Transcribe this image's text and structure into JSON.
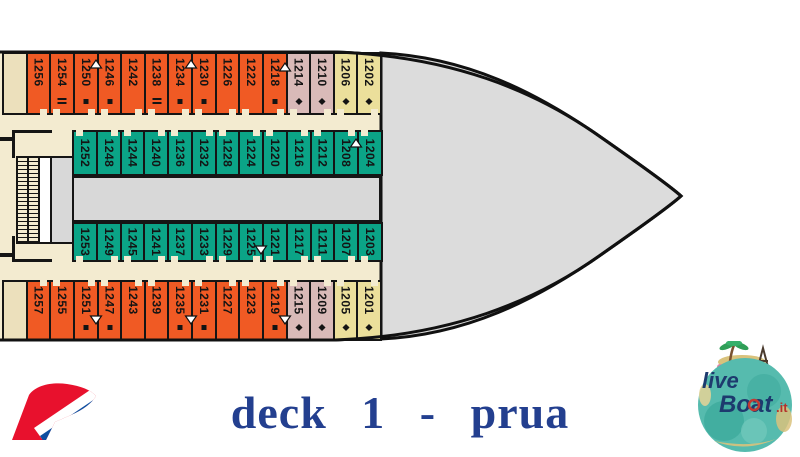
{
  "footer": {
    "title": "deck 1 - prua"
  },
  "logos": {
    "carnival": "carnival-funnel-logo",
    "liveboat": {
      "live": "live",
      "boat": "Boat",
      "it": ".it"
    }
  },
  "colors": {
    "cabin_orange": "#f05a24",
    "cabin_teal": "#0ba487",
    "cabin_pink": "#d9bab8",
    "cabin_yellow": "#ebdf9b",
    "corridor_cream": "#f3ebd0",
    "hull_gray": "#dcdcdc",
    "title_blue": "#233f8f"
  },
  "deck": {
    "rows": [
      {
        "name": "cabins-top-outer",
        "y": 52,
        "h": 63,
        "x0": 2,
        "x1": 380,
        "door": "bottom",
        "center": false,
        "cabins": [
          {
            "n": "",
            "t": "empty"
          },
          {
            "n": "1256",
            "t": "orange"
          },
          {
            "n": "1254",
            "t": "orange",
            "sym": "dblbar"
          },
          {
            "n": "1250",
            "t": "orange",
            "sym": "square"
          },
          {
            "n": "1246",
            "t": "orange",
            "sym": "square"
          },
          {
            "n": "1242",
            "t": "orange"
          },
          {
            "n": "1238",
            "t": "orange",
            "sym": "dblbar"
          },
          {
            "n": "1234",
            "t": "orange",
            "sym": "square"
          },
          {
            "n": "1230",
            "t": "orange",
            "sym": "square"
          },
          {
            "n": "1226",
            "t": "orange"
          },
          {
            "n": "1222",
            "t": "orange"
          },
          {
            "n": "1218",
            "t": "orange",
            "sym": "square"
          },
          {
            "n": "1214",
            "t": "pink",
            "sym": "diamond"
          },
          {
            "n": "1210",
            "t": "pink",
            "sym": "diamond"
          },
          {
            "n": "1206",
            "t": "beige",
            "sym": "diamond"
          },
          {
            "n": "1202",
            "t": "beige",
            "sym": "diamond"
          }
        ]
      },
      {
        "name": "cabins-top-inner",
        "y": 130,
        "h": 46,
        "x0": 72,
        "x1": 381,
        "door": "top",
        "center": true,
        "cabins": [
          {
            "n": "1252",
            "t": "teal"
          },
          {
            "n": "1248",
            "t": "teal"
          },
          {
            "n": "1244",
            "t": "teal"
          },
          {
            "n": "1240",
            "t": "teal"
          },
          {
            "n": "1236",
            "t": "teal"
          },
          {
            "n": "1232",
            "t": "teal"
          },
          {
            "n": "1228",
            "t": "teal"
          },
          {
            "n": "1224",
            "t": "teal"
          },
          {
            "n": "1220",
            "t": "teal"
          },
          {
            "n": "1216",
            "t": "teal"
          },
          {
            "n": "1212",
            "t": "teal"
          },
          {
            "n": "1208",
            "t": "teal"
          },
          {
            "n": "1204",
            "t": "teal"
          }
        ]
      },
      {
        "name": "cabins-bottom-inner",
        "y": 222,
        "h": 40,
        "x0": 72,
        "x1": 381,
        "door": "bottom",
        "center": true,
        "cabins": [
          {
            "n": "1253",
            "t": "teal"
          },
          {
            "n": "1249",
            "t": "teal"
          },
          {
            "n": "1245",
            "t": "teal"
          },
          {
            "n": "1241",
            "t": "teal"
          },
          {
            "n": "1237",
            "t": "teal"
          },
          {
            "n": "1233",
            "t": "teal"
          },
          {
            "n": "1229",
            "t": "teal"
          },
          {
            "n": "1225",
            "t": "teal"
          },
          {
            "n": "1221",
            "t": "teal"
          },
          {
            "n": "1217",
            "t": "teal"
          },
          {
            "n": "1211",
            "t": "teal"
          },
          {
            "n": "1207",
            "t": "teal"
          },
          {
            "n": "1203",
            "t": "teal"
          }
        ]
      },
      {
        "name": "cabins-bottom-outer",
        "y": 280,
        "h": 61,
        "x0": 2,
        "x1": 380,
        "door": "top",
        "center": false,
        "cabins": [
          {
            "n": "",
            "t": "empty"
          },
          {
            "n": "1257",
            "t": "orange"
          },
          {
            "n": "1255",
            "t": "orange"
          },
          {
            "n": "1251",
            "t": "orange",
            "sym": "square"
          },
          {
            "n": "1247",
            "t": "orange",
            "sym": "square"
          },
          {
            "n": "1243",
            "t": "orange"
          },
          {
            "n": "1239",
            "t": "orange"
          },
          {
            "n": "1235",
            "t": "orange",
            "sym": "square"
          },
          {
            "n": "1231",
            "t": "orange",
            "sym": "square"
          },
          {
            "n": "1227",
            "t": "orange"
          },
          {
            "n": "1223",
            "t": "orange"
          },
          {
            "n": "1219",
            "t": "orange",
            "sym": "square"
          },
          {
            "n": "1215",
            "t": "pink",
            "sym": "diamond"
          },
          {
            "n": "1209",
            "t": "pink",
            "sym": "diamond"
          },
          {
            "n": "1205",
            "t": "beige",
            "sym": "diamond"
          },
          {
            "n": "1201",
            "t": "beige",
            "sym": "diamond"
          }
        ]
      }
    ],
    "triangles": [
      {
        "at": "1250-1246",
        "x": 96,
        "y": 60,
        "dir": "up"
      },
      {
        "at": "1234-1230",
        "x": 191,
        "y": 60,
        "dir": "up"
      },
      {
        "at": "1218-1214",
        "x": 285,
        "y": 63,
        "dir": "up"
      },
      {
        "at": "1208-1204",
        "x": 356,
        "y": 139,
        "dir": "up"
      },
      {
        "at": "1225-1221",
        "x": 261,
        "y": 246,
        "dir": "down"
      },
      {
        "at": "1251-1247",
        "x": 96,
        "y": 316,
        "dir": "down"
      },
      {
        "at": "1235-1231",
        "x": 191,
        "y": 316,
        "dir": "down"
      },
      {
        "at": "1219-1215",
        "x": 285,
        "y": 316,
        "dir": "down"
      }
    ]
  }
}
